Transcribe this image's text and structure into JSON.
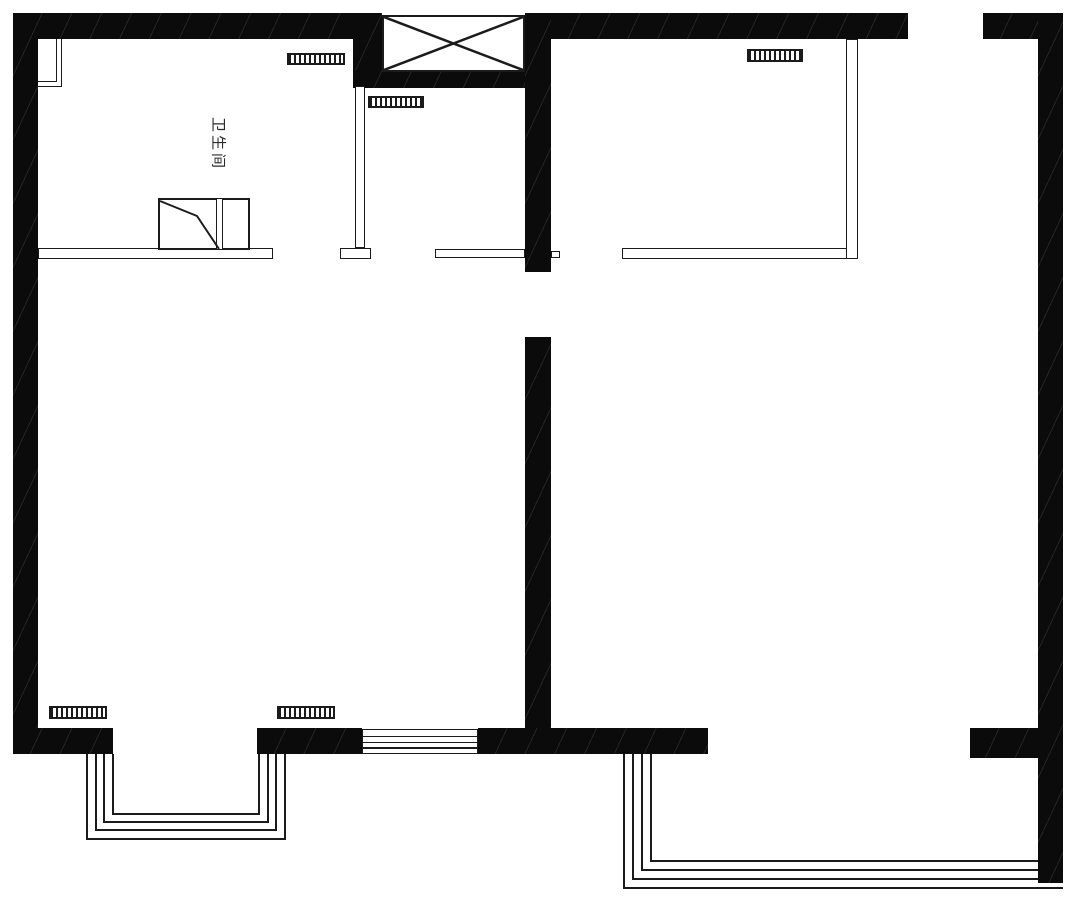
{
  "floorplan": {
    "title": "apartment floor plan",
    "rooms": {
      "bathroom": {
        "label": "卫生间"
      }
    },
    "colors": {
      "wall": "#0b0b0b",
      "line": "#1b1b1b",
      "background": "#ffffff"
    },
    "symbols": [
      "shaft-x-box",
      "folding-door",
      "radiator-grille-x5",
      "bay-window-4-lines",
      "balcony-glazing-4-lines",
      "sliding-door"
    ]
  }
}
